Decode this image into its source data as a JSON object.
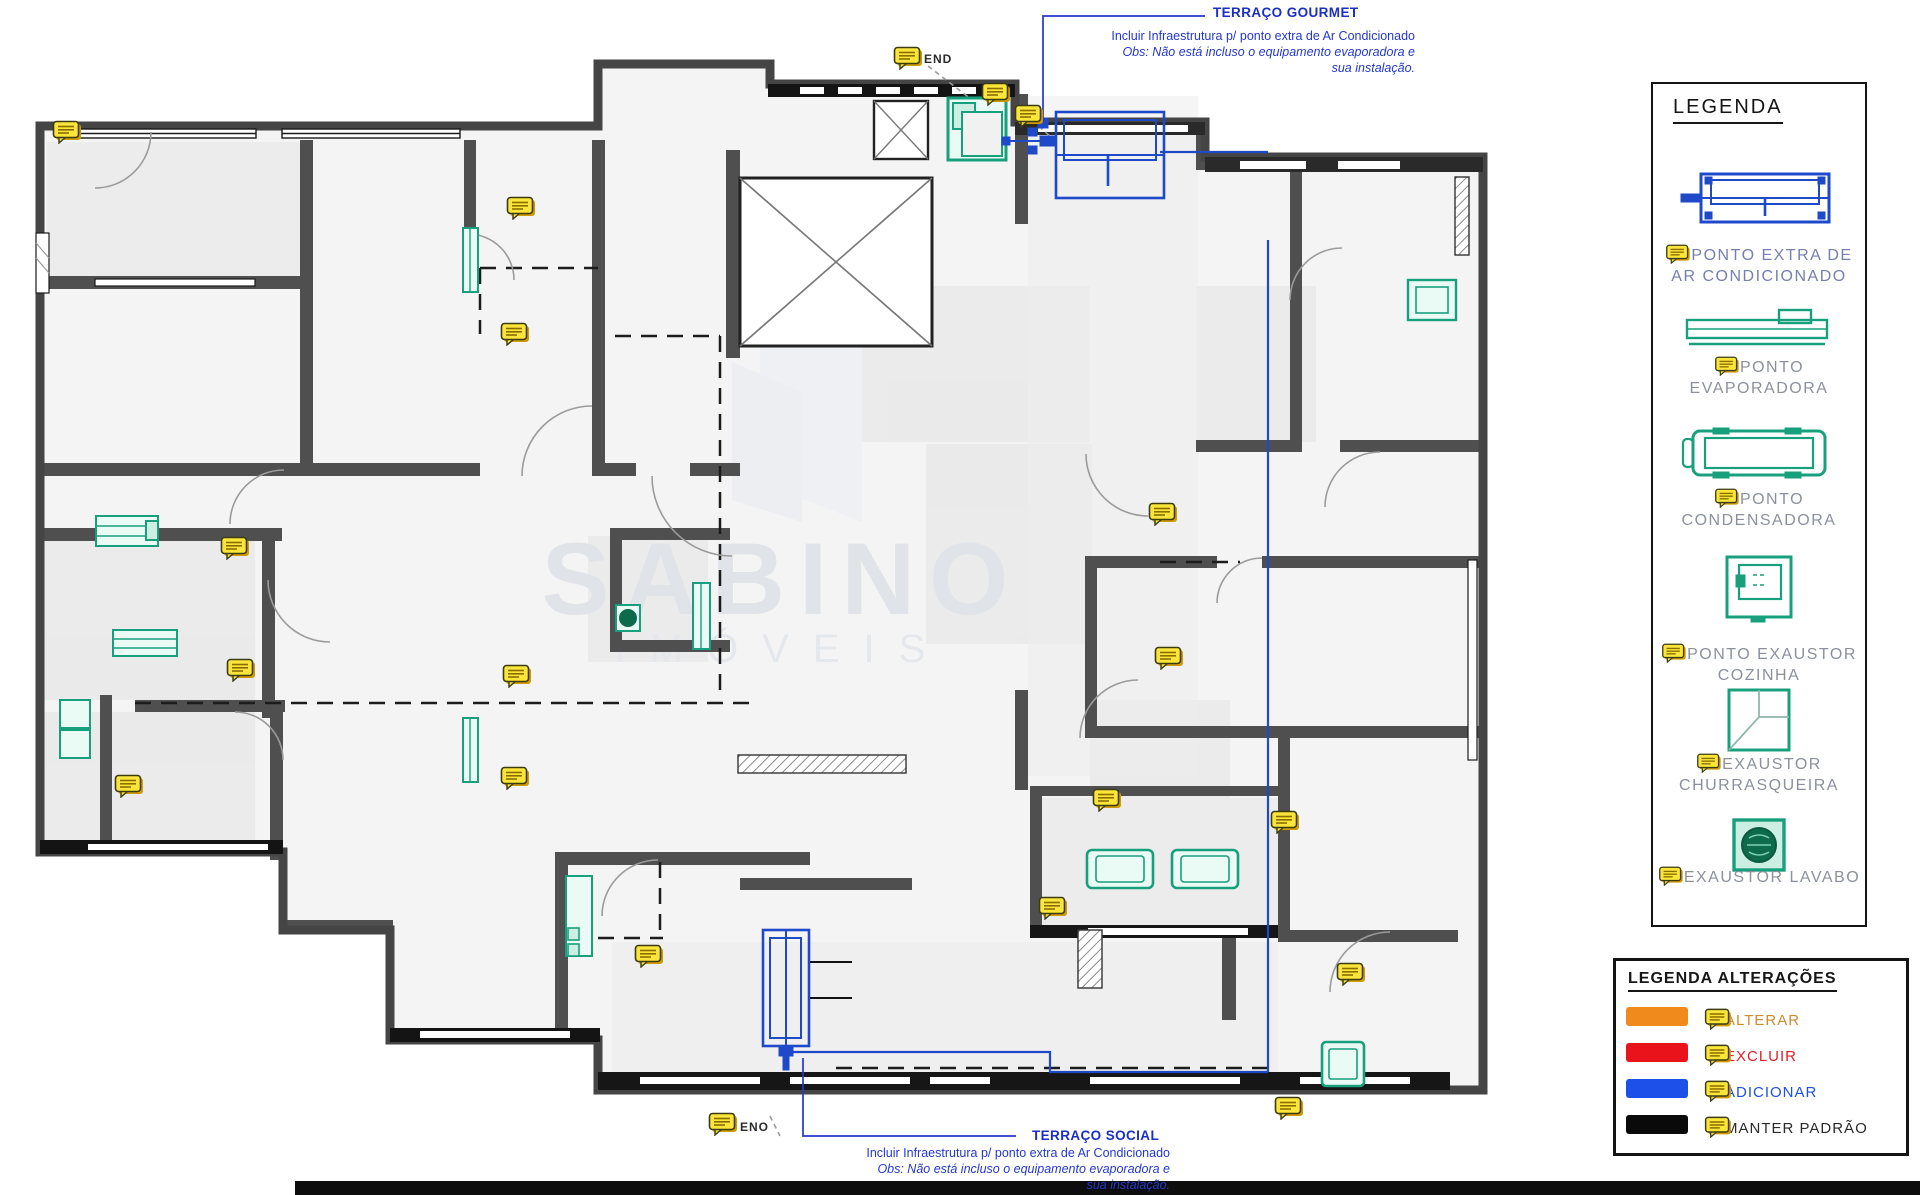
{
  "plan": {
    "top_marker_label": "END",
    "bottom_marker_label": "ENO",
    "gourmet_note": {
      "title": "TERRAÇO GOURMET",
      "line1": "Incluir Infraestrutura p/ ponto extra de Ar Condicionado",
      "line2": "Obs: Não está incluso o equipamento  evaporadora e",
      "line3": "sua instalação."
    },
    "social_note": {
      "title": "TERRAÇO SOCIAL",
      "line1": "Incluir Infraestrutura p/ ponto extra de Ar Condicionado",
      "line2": "Obs: Não está incluso o equipamento  evaporadora e",
      "line3": "sua instalação."
    }
  },
  "watermark": {
    "name": "SABINO",
    "subtitle": "IMÓVEIS"
  },
  "legend": {
    "title": "LEGENDA",
    "items": [
      {
        "id": "ac-extra-point",
        "label": "PONTO EXTRA DE AR CONDICIONADO"
      },
      {
        "id": "evaporadora-point",
        "label": "PONTO EVAPORADORA"
      },
      {
        "id": "condensadora-point",
        "label": "PONTO CONDENSADORA"
      },
      {
        "id": "exaustor-cozinha-point",
        "label": "PONTO EXAUSTOR COZINHA"
      },
      {
        "id": "exaustor-churrasqueira",
        "label": "EXAUSTOR CHURRASQUEIRA"
      },
      {
        "id": "exaustor-lavabo",
        "label": "EXAUSTOR LAVABO"
      }
    ]
  },
  "alteracoes": {
    "title": "LEGENDA ALTERAÇÕES",
    "items": [
      {
        "label": "ALTERAR",
        "color": "#F08A1D"
      },
      {
        "label": "EXCLUIR",
        "color": "#E8131B"
      },
      {
        "label": "ADICIONAR",
        "color": "#1D50E8"
      },
      {
        "label": "MANTER PADRÃO",
        "color": "#0A0A0A"
      }
    ]
  },
  "icons": {
    "comment_bubble": "revision-comment-marker"
  },
  "colors": {
    "annotation_blue": "#2438cc",
    "cad_teal": "#18a07c",
    "cad_blue": "#1e49c8",
    "marker_yellow": "#FFE437",
    "wall_dark": "#454545"
  }
}
